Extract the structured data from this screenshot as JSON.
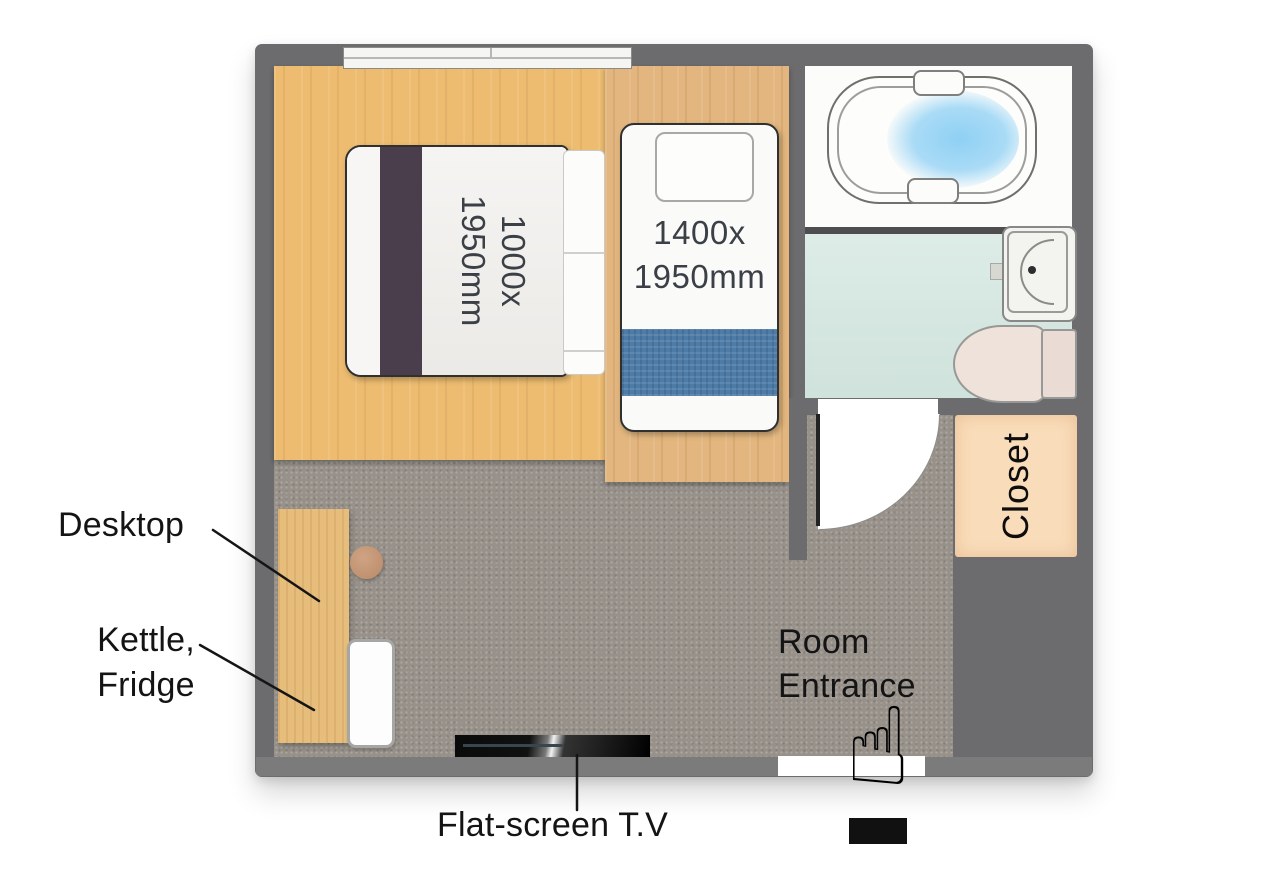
{
  "plan": {
    "beds": {
      "double_size": {
        "line1": "1000x",
        "line2": "1950mm"
      },
      "single_size": {
        "line1": "1400x",
        "line2": "1950mm"
      }
    },
    "closet_label": "Closet",
    "annotations": {
      "desktop_label": "Desktop",
      "kettle_fridge": {
        "line1": "Kettle,",
        "line2": "Fridge"
      },
      "tv_label": "Flat-screen T.V",
      "entrance": {
        "line1": "Room",
        "line2": "Entrance"
      }
    },
    "icons": {
      "entrance_hand": "☝"
    },
    "colors": {
      "wall": "#6c6c6e",
      "wood_floor": "#edbc70",
      "bed_platform": "#e2b67e",
      "carpet": "#97918a",
      "bath_floor": "#d6e7e1",
      "tub_water": "#8ecdf2",
      "blanket": "#4e7ca8",
      "closet": "#f9dcb9",
      "desk": "#e7bd7b",
      "headboard": "#4b3e4c",
      "dimension_text": "#3a4046",
      "label_text": "#141414"
    }
  }
}
